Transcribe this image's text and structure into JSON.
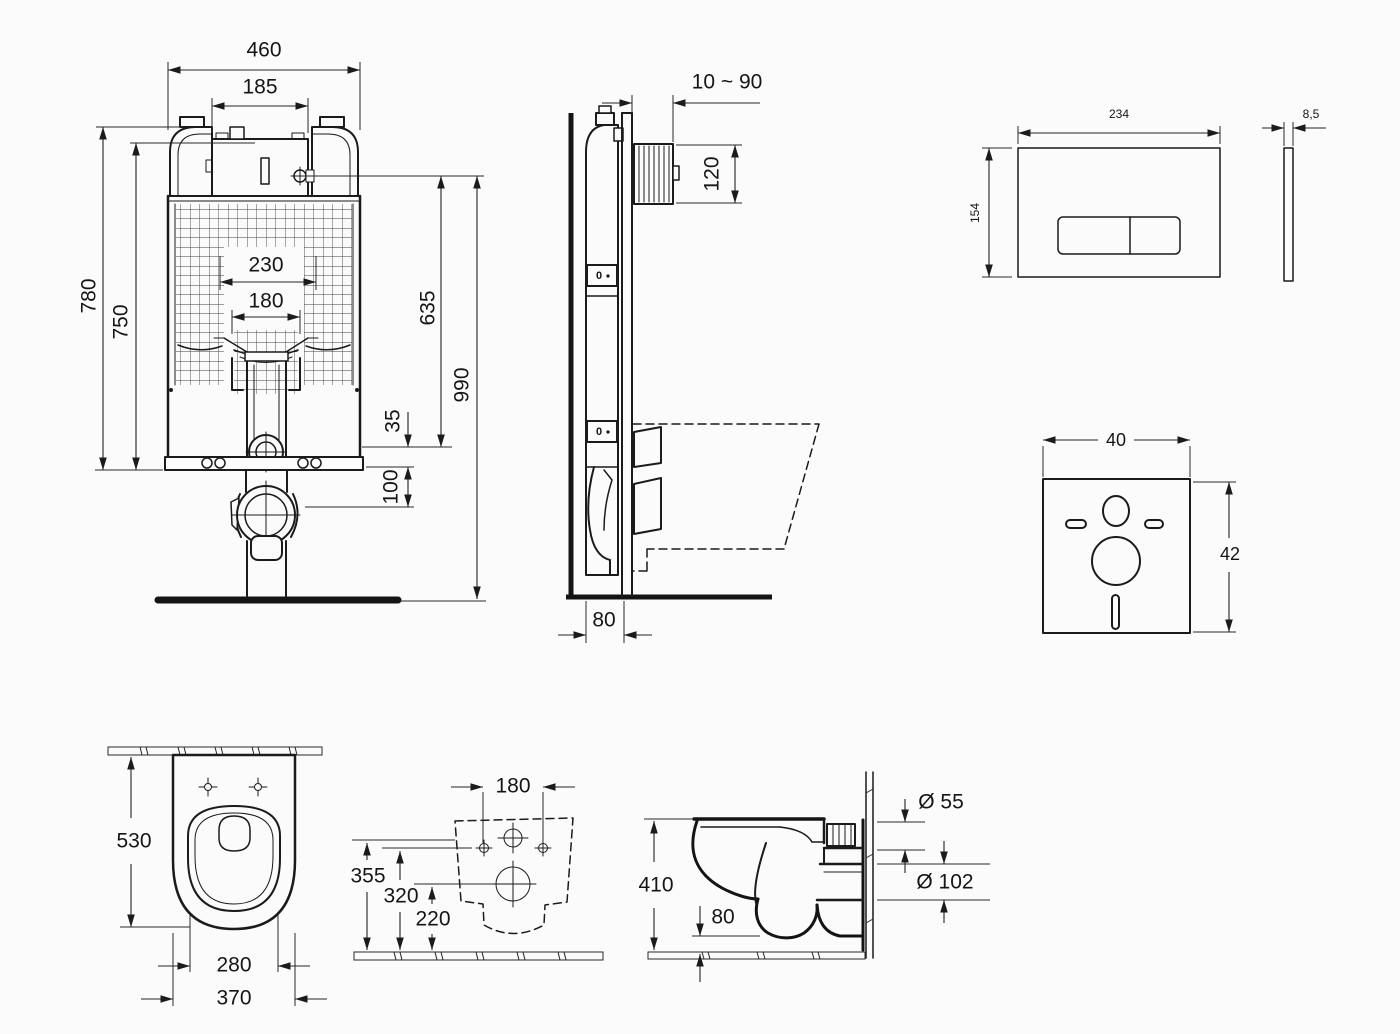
{
  "colors": {
    "ink": "#1b1b1b",
    "background": "#fbfbfb"
  },
  "views": {
    "cistern_front": {
      "dims": {
        "total_width": "460",
        "tank_access_width": "185",
        "bend_width": "230",
        "pipe_width": "180",
        "frame_height": "780",
        "tank_height": "750",
        "valve_height": "635",
        "overall_height": "990",
        "valve_offset": "35",
        "outlet_offset": "100"
      }
    },
    "cistern_side": {
      "dims": {
        "wall_offset_range": "10 ~ 90",
        "inlet_box_height": "120",
        "frame_depth": "80"
      },
      "indicator_label": "0"
    },
    "flush_plate_front": {
      "dims": {
        "width": "234",
        "height": "154"
      }
    },
    "flush_plate_side": {
      "dims": {
        "thickness": "8,5"
      }
    },
    "sound_mat": {
      "dims": {
        "width": "40",
        "height": "42"
      }
    },
    "toilet_top": {
      "dims": {
        "depth": "530",
        "seat_width": "280",
        "bowl_width": "370"
      }
    },
    "toilet_rear": {
      "dims": {
        "hole_spacing": "180",
        "rim_height": "355",
        "hole_height": "320",
        "outlet_height": "220"
      }
    },
    "toilet_side": {
      "dims": {
        "height": "410",
        "trap_clearance": "80",
        "inlet_diameter": "Ø 55",
        "outlet_diameter": "Ø 102"
      }
    }
  }
}
